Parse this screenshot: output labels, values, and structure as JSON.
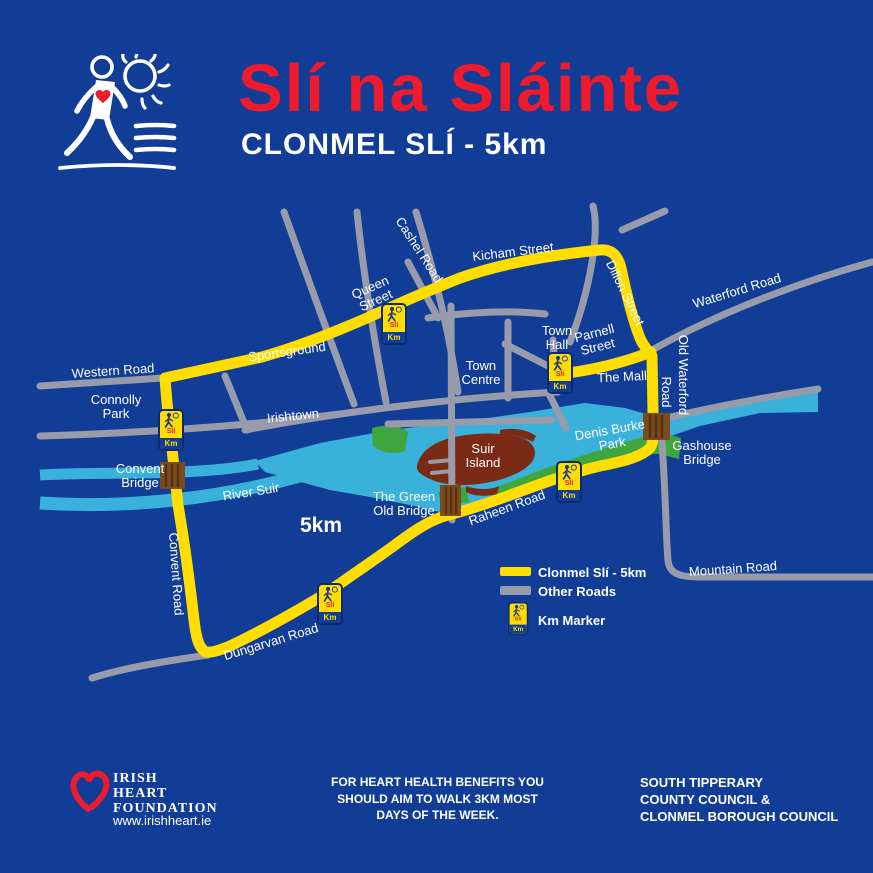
{
  "header": {
    "title": "Slí na Sláinte",
    "subtitle": "CLONMEL SLÍ - 5km"
  },
  "map": {
    "scale_label": "5km",
    "labels": {
      "western_road": "Western Road",
      "connolly_park": "Connolly\nPark",
      "sportsground": "Sportsground",
      "irishtown": "Irishtown",
      "queen_street": "Queen\nStreet",
      "cashel_road": "Cashel Road",
      "kicham_street": "Kicham Street",
      "dillon_street": "Dillon Street",
      "waterford_road": "Waterford Road",
      "old_waterford_road_line1": "Old Waterford",
      "old_waterford_road_line2": "Road",
      "parnell_street": "Parnell\nStreet",
      "town_hall": "Town\nHall",
      "town_centre": "Town\nCentre",
      "the_mall": "The Mall",
      "denis_burke_park": "Denis Burke\nPark",
      "suir_island": "Suir\nIsland",
      "river_suir": "River Suir",
      "convent_bridge": "Convent\nBridge",
      "the_green_old_bridge": "The Green\nOld Bridge",
      "gashouse_bridge": "Gashouse\nBridge",
      "raheen_road": "Raheen Road",
      "mountain_road": "Mountain Road",
      "dungarvan_road": "Dungarvan Road",
      "convent_road": "Convent Road"
    },
    "km_marker": {
      "sli": "Slí",
      "km": "Km"
    }
  },
  "legend": {
    "route_label": "Clonmel Slí - 5km",
    "other_roads_label": "Other Roads",
    "km_marker_label": "Km Marker"
  },
  "footer": {
    "foundation_name": "IRISH\nHEART\nFOUNDATION",
    "foundation_url": "www.irishheart.ie",
    "health_message": "FOR HEART HEALTH BENEFITS YOU\nSHOULD AIM TO WALK 3KM MOST\nDAYS OF THE WEEK.",
    "councils": "SOUTH TIPPERARY\nCOUNTY COUNCIL &\nCLONMEL BOROUGH COUNCIL"
  },
  "colors": {
    "background": "#113D96",
    "title_red": "#ED1B2D",
    "route_yellow": "#FFDD00",
    "road_gray": "#989BA9",
    "river_blue": "#3AB1DA",
    "park_green": "#3FA53F",
    "island_brown": "#7B2A15",
    "bridge_brown": "#7B4A1F"
  }
}
